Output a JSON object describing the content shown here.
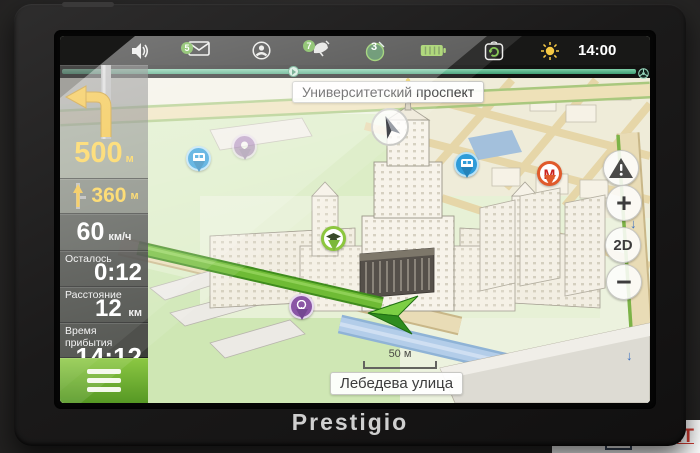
{
  "device": {
    "brand": "Prestigio"
  },
  "watermark": {
    "m": "M",
    "ark": "ARK",
    "it": "IT"
  },
  "statusbar": {
    "time": "14:00",
    "messages_badge": "5",
    "satellite_dish_badge": "7",
    "satellites_count": "3",
    "icons": [
      "volume-icon",
      "messages-icon",
      "profile-icon",
      "satellite-dish-icon",
      "satellites-icon",
      "battery-icon",
      "sync-icon",
      "brightness-icon",
      "steering-wheel-icon"
    ]
  },
  "sidebar": {
    "next_turn_distance": "500",
    "next_turn_distance_unit": "м",
    "second_turn_distance": "360",
    "second_turn_distance_unit": "м",
    "speed": "60",
    "speed_unit": "км/ч",
    "time_left_label": "Осталось",
    "time_left_value": "0:12",
    "distance_label": "Расстояние",
    "distance_value": "12",
    "distance_unit": "км",
    "arrival_label": "Время прибытия",
    "arrival_value": "14:12"
  },
  "map": {
    "street_top": "Университетский проспект",
    "street_bottom": "Лебедева улица",
    "scale_label": "50 м",
    "metro_pin_letter": "М",
    "oneway_glyph": "↓",
    "controls": {
      "zoom_in": "+",
      "view_mode": "2D",
      "zoom_out": "−"
    },
    "colors": {
      "route_green": "#6fbb35",
      "accent_green": "#7ac143",
      "maneuver_yellow": "#f2be34",
      "pin_blue": "#2f9cd9",
      "pin_purple": "#8a56a5",
      "pin_green": "#8cc63e",
      "pin_red": "#e05a2b",
      "road_blue": "#a9c7e4"
    }
  }
}
